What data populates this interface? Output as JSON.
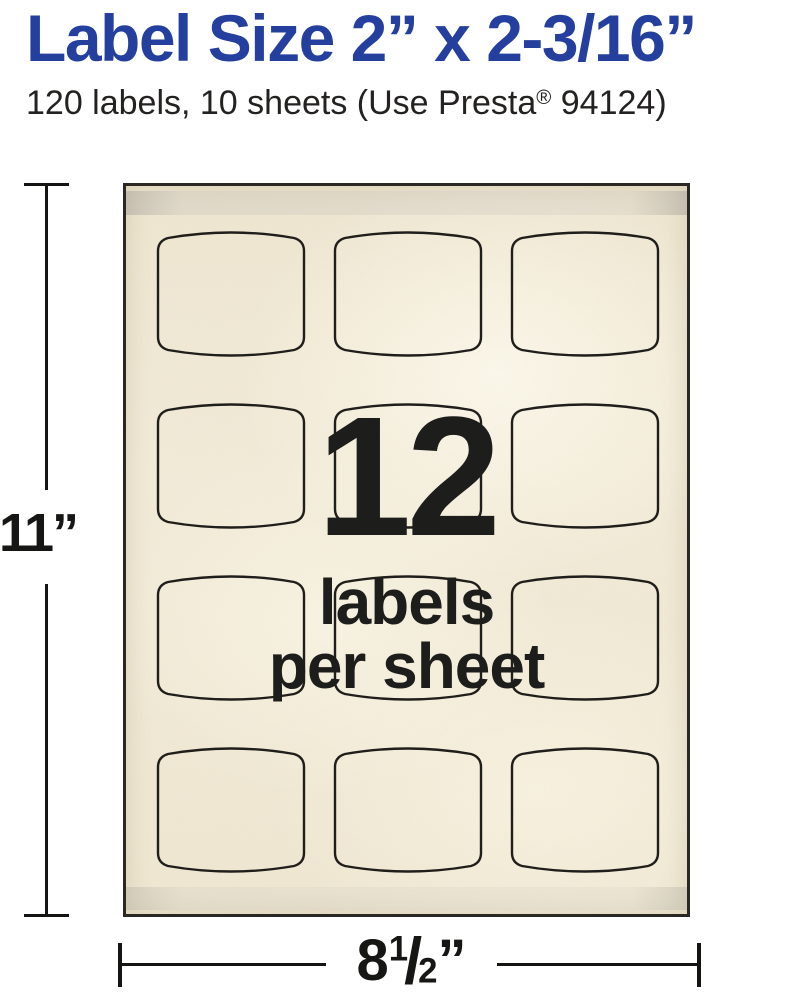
{
  "header": {
    "title": "Label Size 2” x 2-3/16”",
    "subtitle_pre": "120 labels, 10 sheets (Use Presta",
    "subtitle_reg_mark": "®",
    "subtitle_post": " 94124)"
  },
  "sheet": {
    "overlay_count": "12",
    "overlay_line1": "labels",
    "overlay_line2": "per sheet",
    "grid_rows": 4,
    "grid_columns": 3
  },
  "dimensions": {
    "height": "11”",
    "width_whole": "8",
    "width_fraction_numerator": "1",
    "width_fraction_slash": "/",
    "width_fraction_denominator": "2",
    "width_unit": "”"
  },
  "colors": {
    "title_blue": "#243f9e",
    "text_dark": "#1d1d1b",
    "sheet_cream": "#f2ebd7",
    "strip_gray": "#dedace",
    "outline_dark": "#201e1b"
  }
}
